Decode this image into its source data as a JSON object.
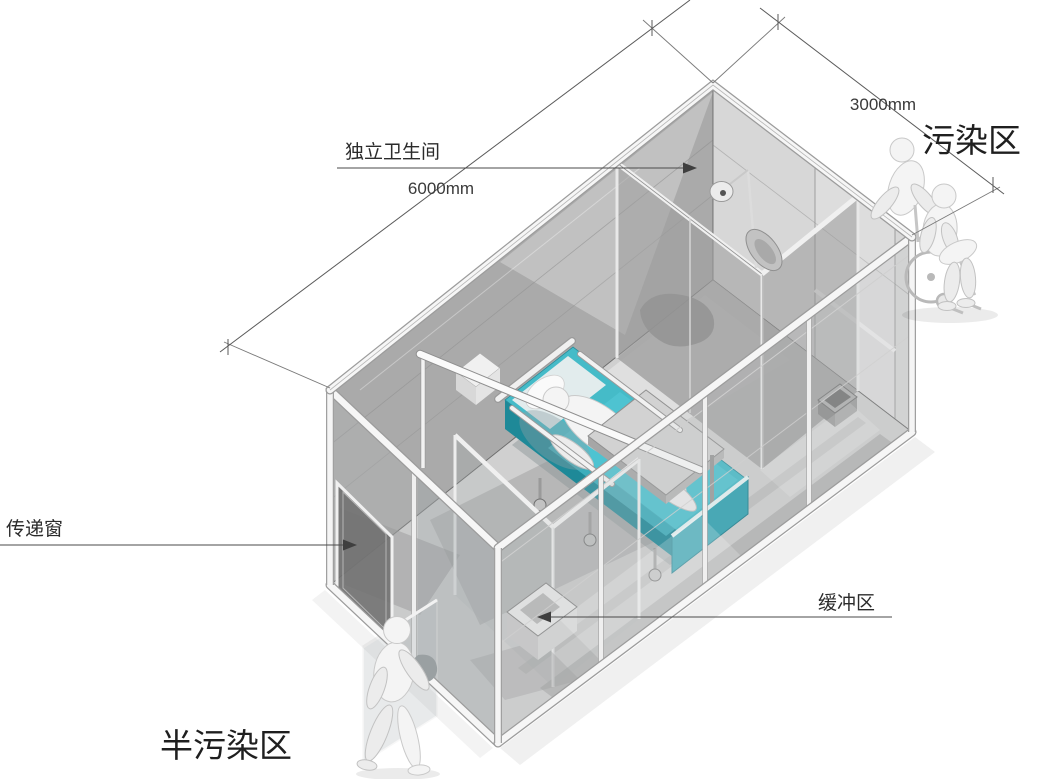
{
  "annotations": {
    "bathroom": {
      "label": "独立卫生间"
    },
    "length_dimension": {
      "label": "6000mm"
    },
    "width_dimension": {
      "label": "3000mm"
    },
    "contaminated_zone": {
      "label": "污染区"
    },
    "transfer_window": {
      "label": "传递窗"
    },
    "buffer_zone": {
      "label": "缓冲区"
    },
    "semi_contaminated_zone": {
      "label": "半污染区"
    }
  },
  "colors": {
    "background": "#ffffff",
    "bed_teal_top": "#45BBC8",
    "bed_teal_side": "#1E8998",
    "bed_teal_footboard": "#2BA2B2",
    "wall_gray": "#AAAAAA",
    "wall_light_gray": "#D6D6D6",
    "floor_gray": "#D0D0D0",
    "annotation_line": "#4A4A4A",
    "text": "#2B2B2B"
  }
}
